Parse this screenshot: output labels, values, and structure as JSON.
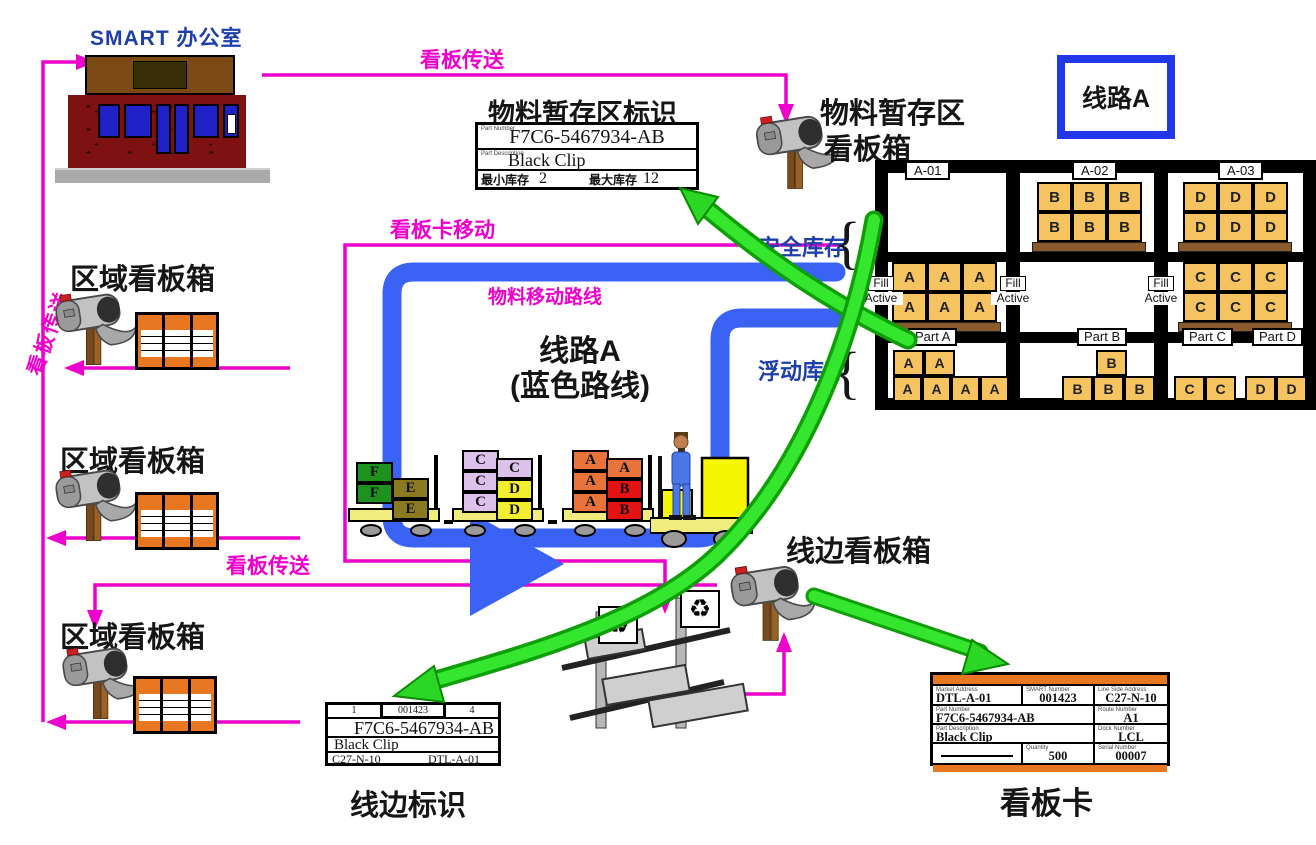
{
  "colors": {
    "magenta": "#EE00CC",
    "route_blue": "#3A63F5",
    "title_blue": "#1C3FAA",
    "green_arrow": "#2BD625",
    "crate_tan": "#F5C360",
    "orange_card": "#E87722",
    "brick": "#7E1212"
  },
  "office": {
    "title": "SMART 办公室"
  },
  "flows": {
    "kanban_transfer_vertical": "看板传送",
    "kanban_transfer_top": "看板传送",
    "kanban_transfer_mid": "看板传送",
    "kanban_card_move": "看板卡移动",
    "material_route": "物料移动路线"
  },
  "route_box": {
    "label": "线路A"
  },
  "line_a": {
    "line1": "线路A",
    "line2": "(蓝色路线)"
  },
  "staging": {
    "title": "物料暂存区标识",
    "box_line1": "物料暂存区",
    "box_line2": "看板箱",
    "card": {
      "part_number_label": "Part Number",
      "part_number": "F7C6-5467934-AB",
      "part_desc_label": "Part Description",
      "part_desc": "Black Clip",
      "min_label": "最小库存",
      "min_value": "2",
      "max_label": "最大库存",
      "max_value": "12"
    }
  },
  "stock": {
    "safety": "安全库存",
    "floating": "浮动库存",
    "brace": "{"
  },
  "region_boxes": {
    "title1": "区域看板箱",
    "title2": "区域看板箱",
    "title3": "区域看板箱"
  },
  "line_side": {
    "box_title": "线边看板箱",
    "card_title": "线边标识",
    "card": {
      "cell_left": "1",
      "cell_mid": "001423",
      "cell_right": "4",
      "part_number": "F7C6-5467934-AB",
      "part_desc": "Black Clip",
      "address_left": "C27-N-10",
      "address_right": "DTL-A-01"
    }
  },
  "kanban_card": {
    "title": "看板卡",
    "market_address_label": "Market Address",
    "market_address": "DTL-A-01",
    "smart_number_label": "SMART Number",
    "smart_number": "001423",
    "line_side_address_label": "Line Side Address",
    "line_side_address": "C27-N-10",
    "part_number_label": "Part Number",
    "part_number": "F7C6-5467934-AB",
    "route_number_label": "Route Number",
    "route_number": "A1",
    "part_desc_label": "Part Description",
    "part_desc": "Black Clip",
    "dock_number_label": "Dock Number",
    "dock_number": "LCL",
    "quantity_label": "Quantity",
    "quantity": "500",
    "serial_number_label": "Serial Number",
    "serial_number": "00007"
  },
  "rack": {
    "fill_tag": {
      "line1": "Fill",
      "line2": "Active"
    },
    "bays": [
      {
        "shelf_label": "A-01",
        "part_labels": [
          "Part A"
        ],
        "upper": [],
        "middle": [
          "A",
          "A",
          "A",
          "A",
          "A",
          "A"
        ],
        "floor_top": [
          "A",
          "A"
        ],
        "floor_bottom": [
          "A",
          "A",
          "A",
          "A"
        ]
      },
      {
        "shelf_label": "A-02",
        "part_labels": [
          "Part B"
        ],
        "upper": [
          "B",
          "B",
          "B",
          "B",
          "B",
          "B"
        ],
        "middle": [],
        "floor_top": [
          "B"
        ],
        "floor_bottom": [
          "B",
          "B",
          "B"
        ]
      },
      {
        "shelf_label": "A-03",
        "part_labels": [
          "Part C",
          "Part D"
        ],
        "upper": [
          "D",
          "D",
          "D",
          "D",
          "D",
          "D"
        ],
        "middle": [
          "C",
          "C",
          "C",
          "C",
          "C",
          "C"
        ],
        "floor_top": [],
        "floor_bottom": [
          "C",
          "C",
          "D",
          "D"
        ]
      }
    ]
  },
  "train": {
    "cart1": {
      "left": [
        "F",
        "F"
      ],
      "right": [
        "E",
        "E"
      ]
    },
    "cart2": {
      "left": [
        "C",
        "C",
        "C"
      ],
      "right_top": "C",
      "right_mid": "D",
      "right_bot": "D"
    },
    "cart3": {
      "left": [
        "A",
        "A",
        "A"
      ],
      "right_top": "A",
      "right_mid": "B",
      "right_bot": "B"
    }
  },
  "icons": {
    "recycle": "♻"
  }
}
